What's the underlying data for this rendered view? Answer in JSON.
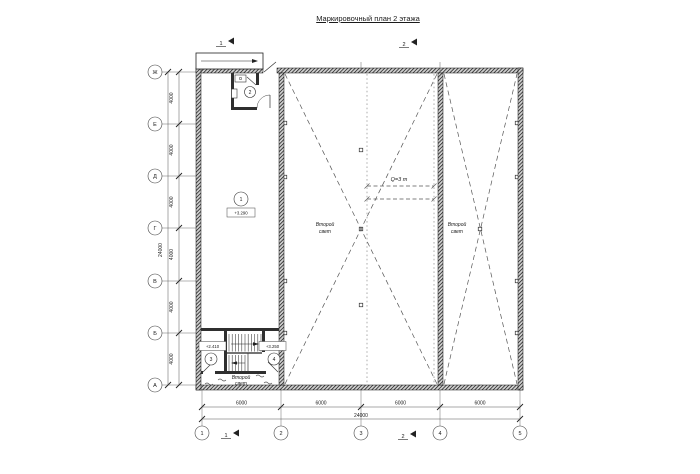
{
  "title": "Маркировочный план 2 этажа",
  "grid": {
    "rows": [
      "Ж",
      "Е",
      "Д",
      "Г",
      "В",
      "Б",
      "А"
    ],
    "cols": [
      "1",
      "2",
      "3",
      "4",
      "5"
    ]
  },
  "dims": {
    "row": [
      "4000",
      "4000",
      "4000",
      "4000",
      "4000",
      "4000"
    ],
    "row_total": "24000",
    "col": [
      "6000",
      "6000",
      "6000",
      "6000"
    ],
    "col_total": "24000"
  },
  "rooms": {
    "room1": {
      "number": "1",
      "elevation": "+3.290"
    },
    "room2": {
      "number": "2"
    },
    "room3": {
      "number": "3",
      "elevation": "+2.410"
    },
    "room4": {
      "number": "4",
      "elevation": "+3.250"
    }
  },
  "labels": {
    "second_light_line1": "Второй",
    "second_light_line2": "свет",
    "crane": "Q=3 т"
  },
  "sections": {
    "s1": "1",
    "s2": "2"
  },
  "colors": {
    "line": "#1a1a1a",
    "wall": "#2f2f2f",
    "dash": "#555555",
    "rail": "#b5b5b5"
  }
}
